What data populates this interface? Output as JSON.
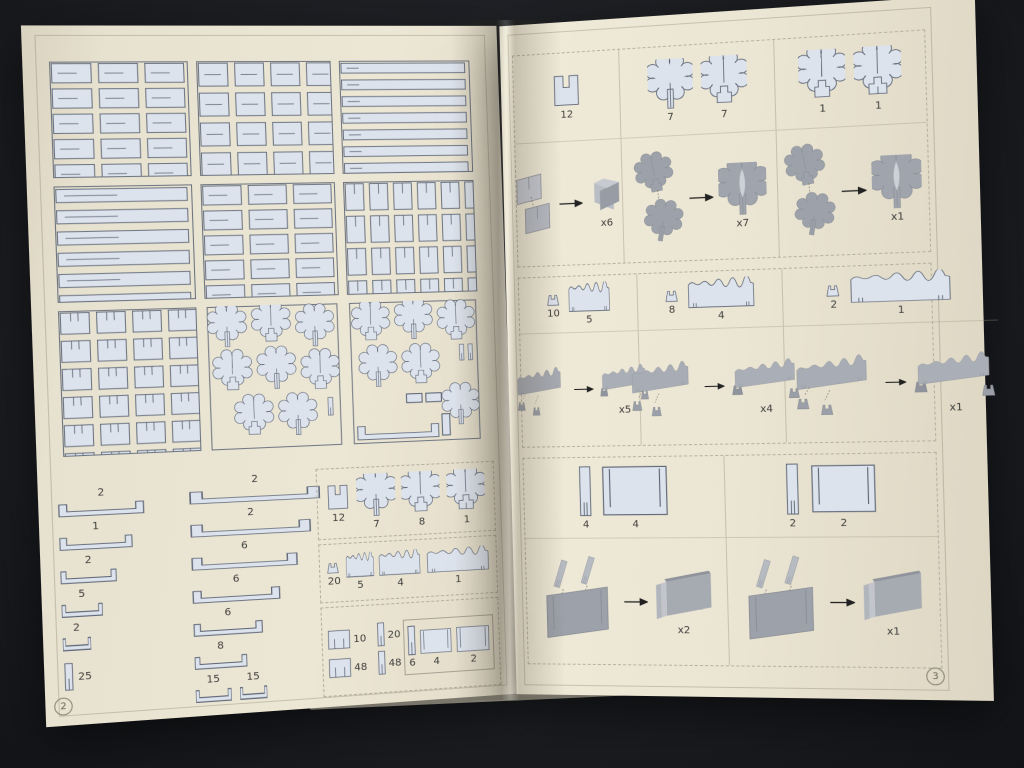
{
  "colors": {
    "background": "#1b1d21",
    "page": "#eae4d2",
    "part_fill": "#dde3ec",
    "part_outline": "#5f6878",
    "render_grey": "#a8acb4",
    "label_text": "#3e3e3c"
  },
  "left": {
    "page_number": "2",
    "channels_left": [
      "2",
      "1",
      "2",
      "5",
      "2",
      "25"
    ],
    "channels_right": [
      "2",
      "2",
      "6",
      "6",
      "6",
      "8"
    ],
    "channel_pair": [
      "15",
      "15"
    ],
    "tree_row": {
      "stake": "12",
      "tree_a": "7",
      "tree_b": "8",
      "tree_c": "1"
    },
    "fence_row": {
      "post": "20",
      "small": "5",
      "medium": "4",
      "large": "1"
    },
    "small_row": {
      "square": "10",
      "strip": "20",
      "square2": "48",
      "strip2": "48",
      "bar": "6",
      "panel_a": "4",
      "panel_b": "2"
    }
  },
  "right": {
    "page_number": "3",
    "s1": {
      "stake": "12",
      "trees_seven": [
        "7",
        "7"
      ],
      "trees_one": [
        "1",
        "1"
      ],
      "assembly": [
        "x6",
        "x7",
        "x1"
      ]
    },
    "s2": {
      "parts": [
        [
          "10",
          "5"
        ],
        [
          "8",
          "4"
        ],
        [
          "2",
          "1"
        ]
      ],
      "assembly": [
        "x5",
        "x4",
        "x1"
      ]
    },
    "s3": {
      "parts": [
        [
          "4",
          "4"
        ],
        [
          "2",
          "2"
        ]
      ],
      "assembly": [
        "x2",
        "x1"
      ]
    }
  }
}
